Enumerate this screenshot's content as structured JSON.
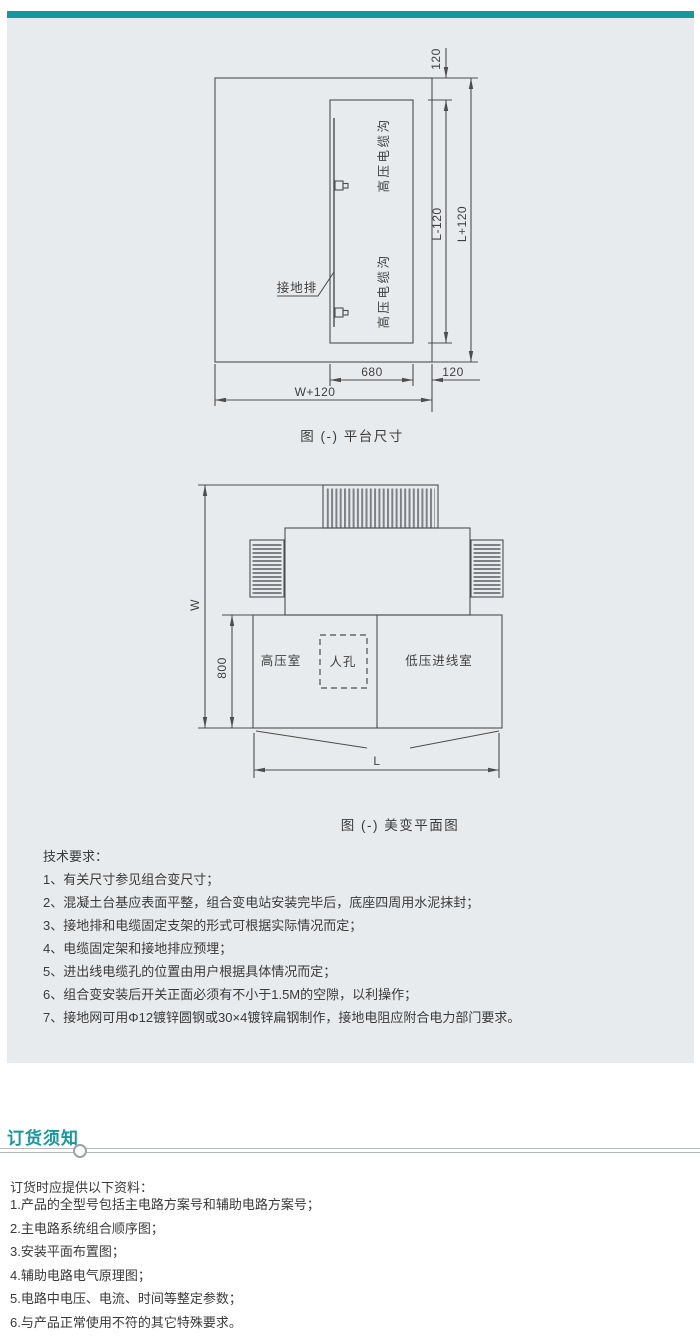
{
  "theme": {
    "accent_teal": "#13989f",
    "panel_bg": "#e8ebee",
    "diagram_line": "#4d4d4d",
    "text_color": "#3a3a3a"
  },
  "figure1": {
    "caption": "图 (-) 平台尺寸",
    "labels": {
      "trench_top": "高压电缆沟",
      "trench_bottom": "高压电缆沟",
      "ground_bar": "接地排"
    },
    "dims": {
      "top_gap": "120",
      "inner_height": "L-120",
      "outer_height": "L+120",
      "trench_width": "680",
      "side_gap": "120",
      "outer_width": "W+120"
    }
  },
  "figure2": {
    "caption": "图 (-) 美变平面图",
    "labels": {
      "hv_room": "高压室",
      "manhole": "人孔",
      "lv_room": "低压进线室"
    },
    "dims": {
      "width": "W",
      "depth": "800",
      "length": "L"
    }
  },
  "tech": {
    "heading": "技术要求：",
    "items": [
      "1、有关尺寸参见组合变尺寸；",
      "2、混凝土台基应表面平整，组合变电站安装完毕后，底座四周用水泥抹封；",
      "3、接地排和电缆固定支架的形式可根据实际情况而定；",
      "4、电缆固定架和接地排应预埋；",
      "5、进出线电缆孔的位置由用户根据具体情况而定；",
      "6、组合变安装后开关正面必须有不小于1.5M的空隙，以利操作；",
      "7、接地网可用Φ12镀锌圆钢或30×4镀锌扁钢制作，接地电阻应附合电力部门要求。"
    ]
  },
  "ordering": {
    "heading": "订货须知",
    "intro": "订货时应提供以下资料：",
    "items": [
      "1.产品的全型号包括主电路方案号和辅助电路方案号；",
      "2.主电路系统组合顺序图；",
      "3.安装平面布置图；",
      "4.辅助电路电气原理图；",
      "5.电路中电压、电流、时间等整定参数；",
      "6.与产品正常使用不符的其它特殊要求。"
    ]
  }
}
